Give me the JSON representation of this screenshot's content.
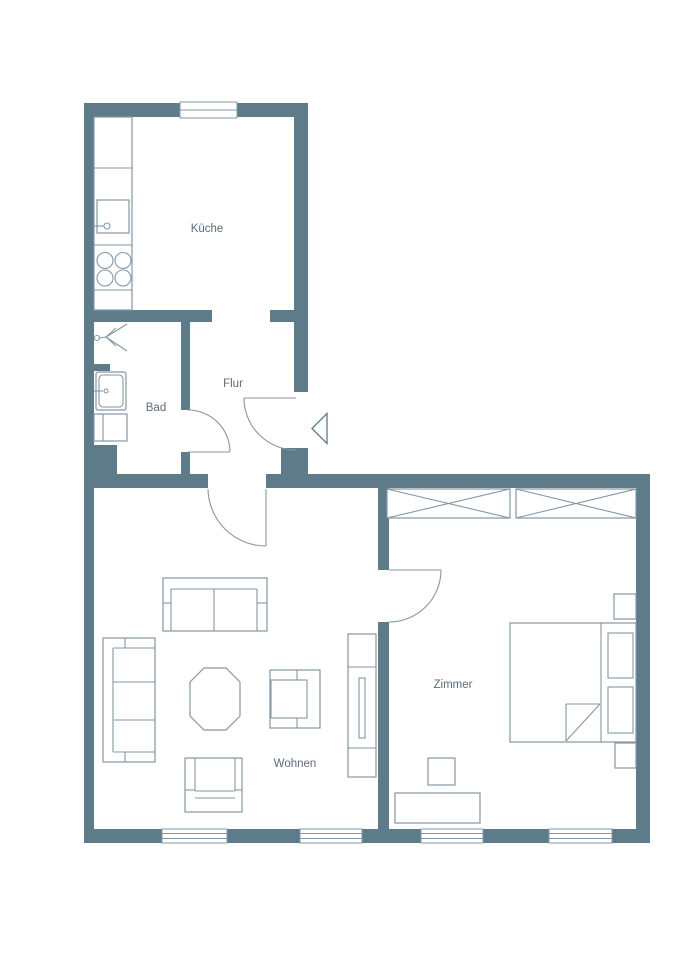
{
  "plan": {
    "type": "apartment-floor-plan",
    "rooms": [
      {
        "id": "kueche",
        "label": "Küche"
      },
      {
        "id": "bad",
        "label": "Bad"
      },
      {
        "id": "flur",
        "label": "Flur"
      },
      {
        "id": "wohnen",
        "label": "Wohnen"
      },
      {
        "id": "zimmer",
        "label": "Zimmer"
      }
    ],
    "colors": {
      "wall": "#5e7b8a",
      "line": "#8497a4",
      "text": "#5d6b7a",
      "floor": "#ffffff"
    },
    "icons": [
      "entrance-arrow",
      "door-swing",
      "window",
      "shower",
      "washbasin",
      "toilet",
      "kitchen-sink",
      "stove",
      "kitchen-counter",
      "wardrobe",
      "bed",
      "nightstand",
      "desk",
      "desk-chair",
      "sofa",
      "armchair",
      "coffee-table",
      "tv-board"
    ]
  }
}
